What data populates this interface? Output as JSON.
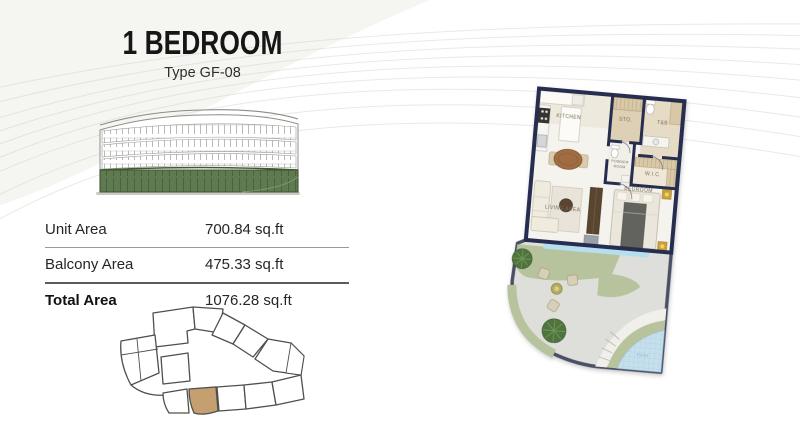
{
  "header": {
    "title": "1 BEDROOM",
    "subtitle": "Type GF-08"
  },
  "area_table": {
    "rows": [
      {
        "label": "Unit Area",
        "value": "700.84 sq.ft"
      },
      {
        "label": "Balcony Area",
        "value": "475.33 sq.ft"
      },
      {
        "label": "Total Area",
        "value": "1076.28 sq.ft"
      }
    ]
  },
  "floor_plan": {
    "labels": {
      "kitchen": "KITCHEN",
      "storage": "STO.",
      "toilet_bath": "T&B",
      "powder_room_line1": "POWDER",
      "powder_room_line2": "ROOM",
      "walk_in_closet": "W.I.C.",
      "bedroom": "BEDROOM",
      "living_area": "LIVING AREA",
      "pool": "POOL"
    },
    "colors": {
      "wall": "#272d4f",
      "balcony_water": "#b5dfef",
      "grass": "#b6c39c",
      "tree": "#50743e",
      "pool_water": "#c6dfed",
      "paving": "#dedfda",
      "tile": "#ddd0b4"
    }
  },
  "site_plan": {
    "highlight_color": "#c59f6f"
  },
  "building": {
    "ground_floor_color": "#5f7a50"
  }
}
